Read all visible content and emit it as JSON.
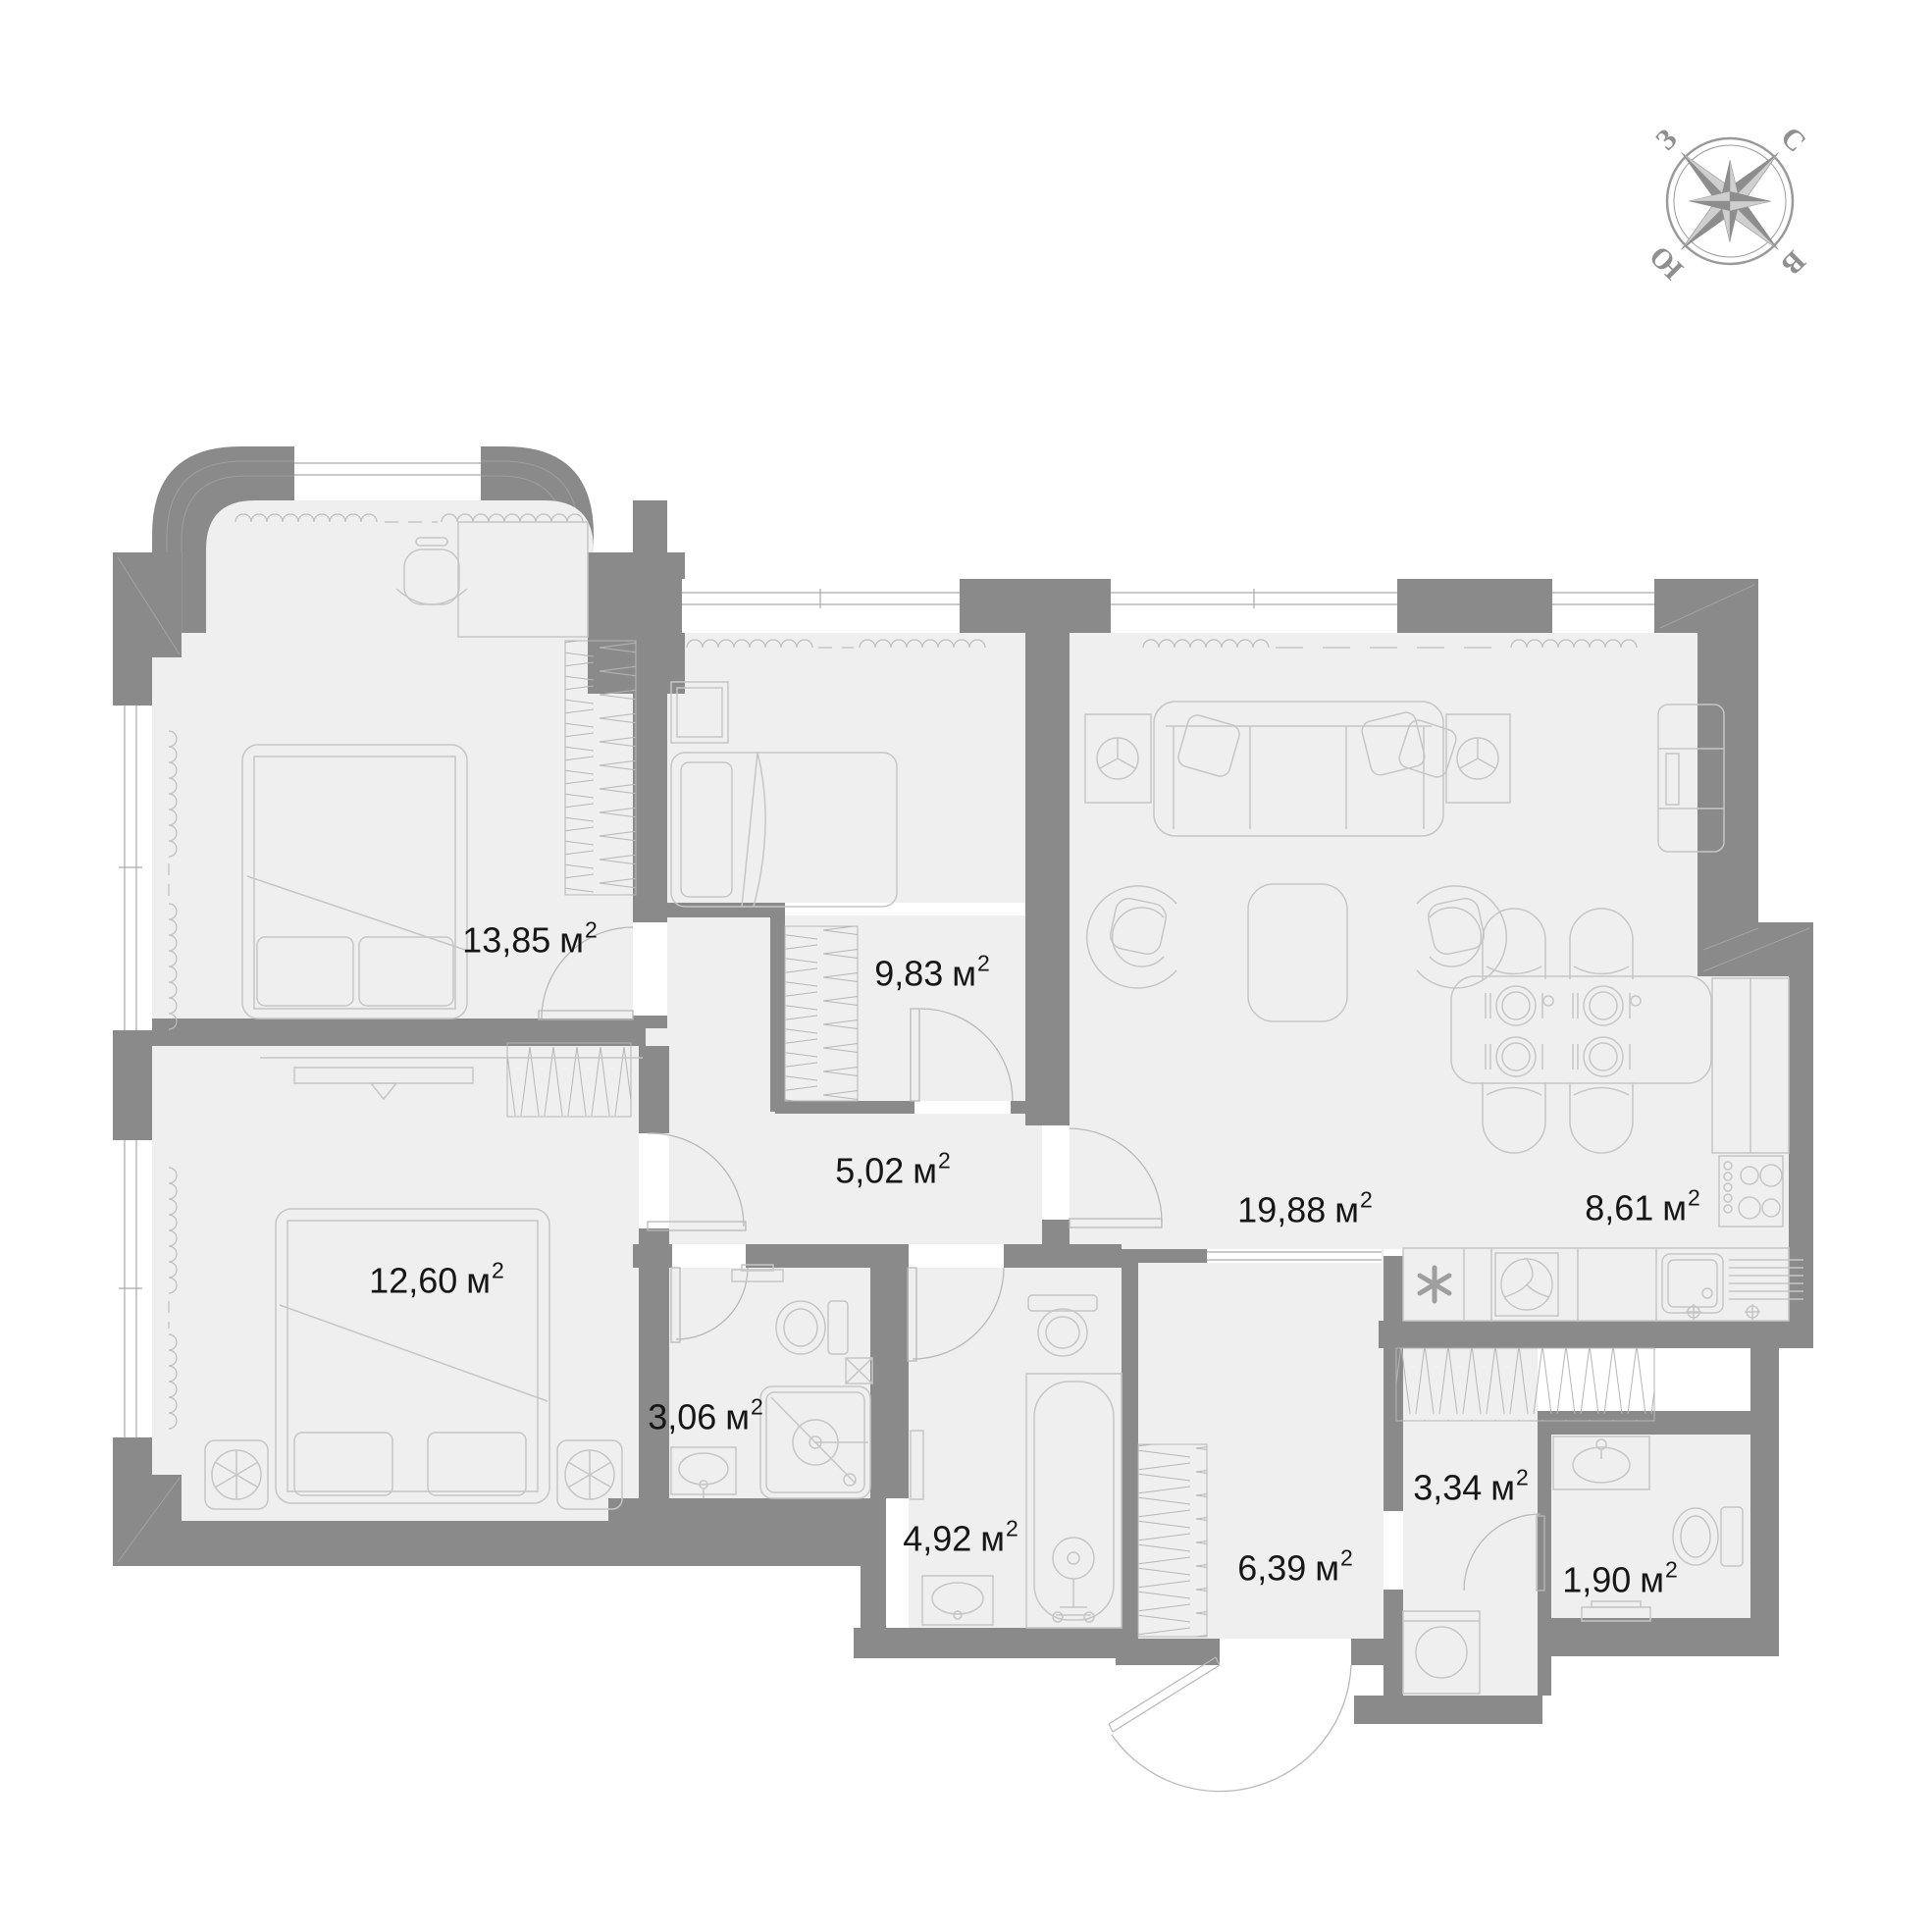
{
  "palette": {
    "background": "#ffffff",
    "wall": "#8a8a8a",
    "floor": "#efefef",
    "furniture_line": "#c6c6c6",
    "hatch_line": "#b6b6b6",
    "label_text": "#161616",
    "compass_gray": "#9a9a9a"
  },
  "compass": {
    "north": "С",
    "east": "В",
    "south": "Ю",
    "west": "З"
  },
  "rooms": [
    {
      "id": "bedroom-1",
      "area": "13,85",
      "unit": "м",
      "sup": "2"
    },
    {
      "id": "bedroom-2",
      "area": "9,83",
      "unit": "м",
      "sup": "2"
    },
    {
      "id": "hallway",
      "area": "5,02",
      "unit": "м",
      "sup": "2"
    },
    {
      "id": "bedroom-3",
      "area": "12,60",
      "unit": "м",
      "sup": "2"
    },
    {
      "id": "bathroom-1",
      "area": "3,06",
      "unit": "м",
      "sup": "2"
    },
    {
      "id": "bathroom-2",
      "area": "4,92",
      "unit": "м",
      "sup": "2"
    },
    {
      "id": "entrance-hall",
      "area": "6,39",
      "unit": "м",
      "sup": "2"
    },
    {
      "id": "living-room",
      "area": "19,88",
      "unit": "м",
      "sup": "2"
    },
    {
      "id": "kitchen",
      "area": "8,61",
      "unit": "м",
      "sup": "2"
    },
    {
      "id": "dressing-room",
      "area": "3,34",
      "unit": "м",
      "sup": "2"
    },
    {
      "id": "wc",
      "area": "1,90",
      "unit": "м",
      "sup": "2"
    }
  ]
}
